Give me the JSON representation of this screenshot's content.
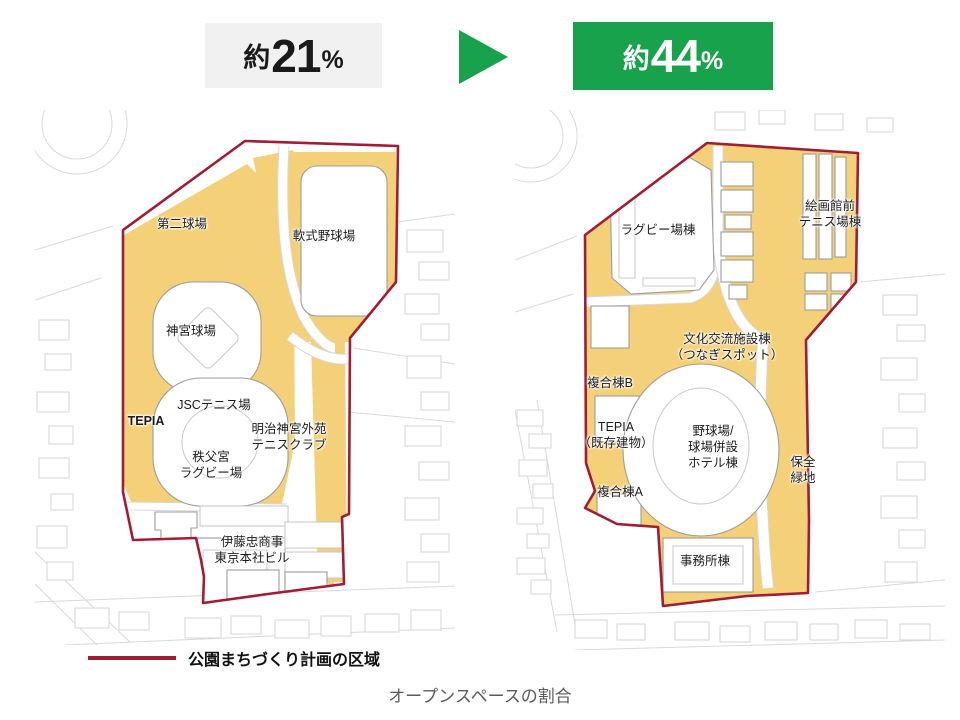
{
  "header": {
    "before": {
      "prefix": "約",
      "value": "21",
      "unit": "%"
    },
    "after": {
      "prefix": "約",
      "value": "44",
      "unit": "%"
    },
    "arrow_icon": "green-right-triangle"
  },
  "maps": {
    "left": {
      "labels": [
        {
          "id": "daini-kyujo",
          "text": "第二球場"
        },
        {
          "id": "nanshiki-yakyujo",
          "text": "軟式野球場"
        },
        {
          "id": "jingu-kyujo",
          "text": "神宮球場"
        },
        {
          "id": "jsc-tennis",
          "text": "JSCテニス場"
        },
        {
          "id": "tepia",
          "text": "TEPIA"
        },
        {
          "id": "meiji-jingu-gaien-tennis-club",
          "text": "明治神宮外苑\nテニスクラブ"
        },
        {
          "id": "chichibunomiya-rugby",
          "text": "秩父宮\nラグビー場"
        },
        {
          "id": "itochu-hq",
          "text": "伊藤忠商事\n東京本社ビル"
        }
      ]
    },
    "right": {
      "labels": [
        {
          "id": "rugby-stadium-bldg",
          "text": "ラグビー場棟"
        },
        {
          "id": "kaigakan-tennis-bldg",
          "text": "絵画館前\nテニス場棟"
        },
        {
          "id": "bunka-koryu-bldg",
          "text": "文化交流施設棟\n（つなぎスポット）"
        },
        {
          "id": "fukugo-b",
          "text": "複合棟B"
        },
        {
          "id": "tepia-existing",
          "text": "TEPIA\n（既存建物）"
        },
        {
          "id": "fukugo-a",
          "text": "複合棟A"
        },
        {
          "id": "yakyujo-hotel-bldg",
          "text": "野球場/\n球場併設\nホテル棟"
        },
        {
          "id": "hozen-ryokuchi",
          "text": "保全\n緑地"
        },
        {
          "id": "jimusho-bldg",
          "text": "事務所棟"
        }
      ]
    }
  },
  "legend": {
    "label": "公園まちづくり計画の区域"
  },
  "caption": {
    "text": "オープンスペースの割合"
  },
  "colors": {
    "accent_green": "#17a24b",
    "boundary_red": "#a01d35",
    "open_space_yellow": "#f4d078",
    "badge_gray_bg": "#f1f1f1",
    "caption_gray": "#5b5b5b"
  }
}
